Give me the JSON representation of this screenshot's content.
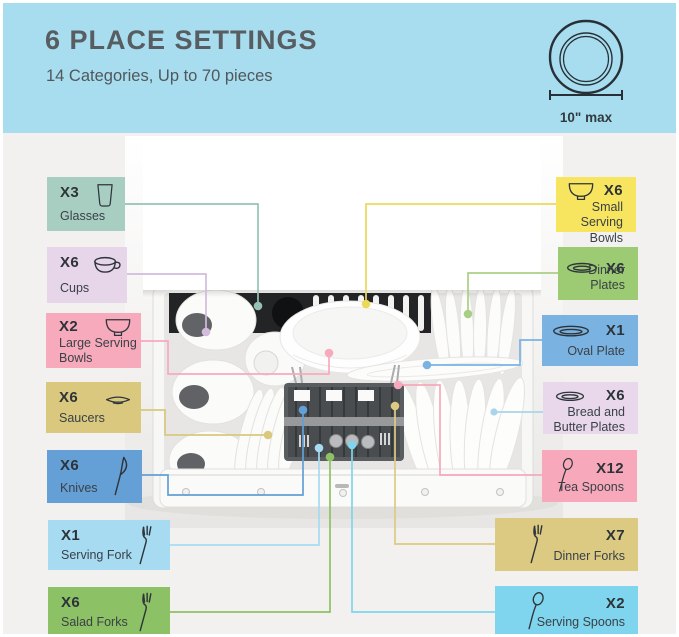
{
  "header": {
    "title": "6 PLACE SETTINGS",
    "subtitle": "14 Categories, Up to 70 pieces",
    "bg_color": "#a7ddef",
    "gauge_label": "10\" max"
  },
  "items": [
    {
      "name": "glasses",
      "count": "X3",
      "label": "Glasses",
      "color": "#a8cec2",
      "line_color": "#96c2b4"
    },
    {
      "name": "cups",
      "count": "X6",
      "label": "Cups",
      "color": "#e7d5ea",
      "line_color": "#d2bcdc"
    },
    {
      "name": "large-serving-bowls",
      "count": "X2",
      "label": "Large Serving Bowls",
      "color": "#f7aabc",
      "line_color": "#f7aabc"
    },
    {
      "name": "saucers",
      "count": "X6",
      "label": "Saucers",
      "color": "#d9c87e",
      "line_color": "#d9c87e"
    },
    {
      "name": "knives",
      "count": "X6",
      "label": "Knives",
      "color": "#649fd6",
      "line_color": "#649fd6"
    },
    {
      "name": "serving-fork",
      "count": "X1",
      "label": "Serving Fork",
      "color": "#a6dbf2",
      "line_color": "#a6dbf2"
    },
    {
      "name": "salad-forks",
      "count": "X6",
      "label": "Salad Forks",
      "color": "#8dc165",
      "line_color": "#8dc165"
    },
    {
      "name": "small-serving-bowls",
      "count": "X6",
      "label": "Small Serving Bowls",
      "color": "#f8e55f",
      "line_color": "#ecd95a"
    },
    {
      "name": "dinner-plates",
      "count": "X6",
      "label": "Dinner Plates",
      "color": "#9ccb73",
      "line_color": "#a9cf85"
    },
    {
      "name": "oval-plate",
      "count": "X1",
      "label": "Oval Plate",
      "color": "#7ab3e2",
      "line_color": "#7ab3e2"
    },
    {
      "name": "bread-and-butter-plates",
      "count": "X6",
      "label": "Bread and Butter Plates",
      "color": "#e9d8ec",
      "line_color": "#aad5e9"
    },
    {
      "name": "tea-spoons",
      "count": "X12",
      "label": "Tea Spoons",
      "color": "#f7a9bb",
      "line_color": "#f7a9bb"
    },
    {
      "name": "dinner-forks",
      "count": "X7",
      "label": "Dinner Forks",
      "color": "#dcca83",
      "line_color": "#dcca83"
    },
    {
      "name": "serving-spoons",
      "count": "X2",
      "label": "Serving Spoons",
      "color": "#7fd5ed",
      "line_color": "#7fd5ed"
    }
  ]
}
